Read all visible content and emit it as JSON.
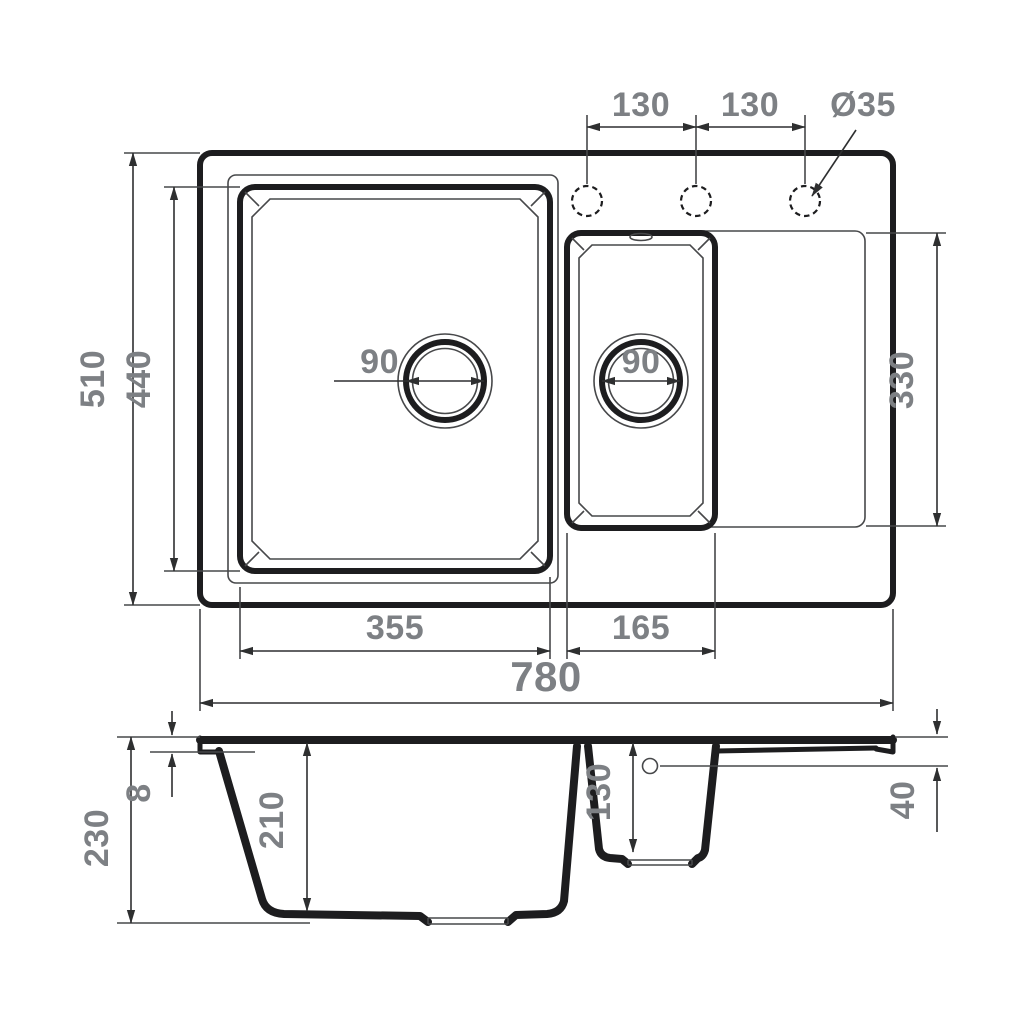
{
  "drawing": {
    "subject": "technical dimension drawing of a 1.5-bowl kitchen sink with drainboard, plan view and cross-section",
    "colors": {
      "line": "#1d1d1f",
      "thin_line": "#47484a",
      "dimension_text": "#7d8084",
      "background": "#ffffff"
    },
    "top_view": {
      "dimensions": {
        "overall_width": "780",
        "overall_depth": "510",
        "bowl_area_depth": "440",
        "main_bowl_width": "355",
        "small_bowl_width": "165",
        "drainboard_depth": "330",
        "main_drain_diameter": "90",
        "small_drain_diameter": "90",
        "tap_hole_spacing_left": "130",
        "tap_hole_spacing_right": "130",
        "tap_hole_diameter": "Ø35"
      }
    },
    "section_view": {
      "dimensions": {
        "total_depth": "230",
        "rim_height": "8",
        "main_bowl_depth": "210",
        "small_bowl_depth": "130",
        "drainboard_edge_height": "40"
      }
    }
  }
}
